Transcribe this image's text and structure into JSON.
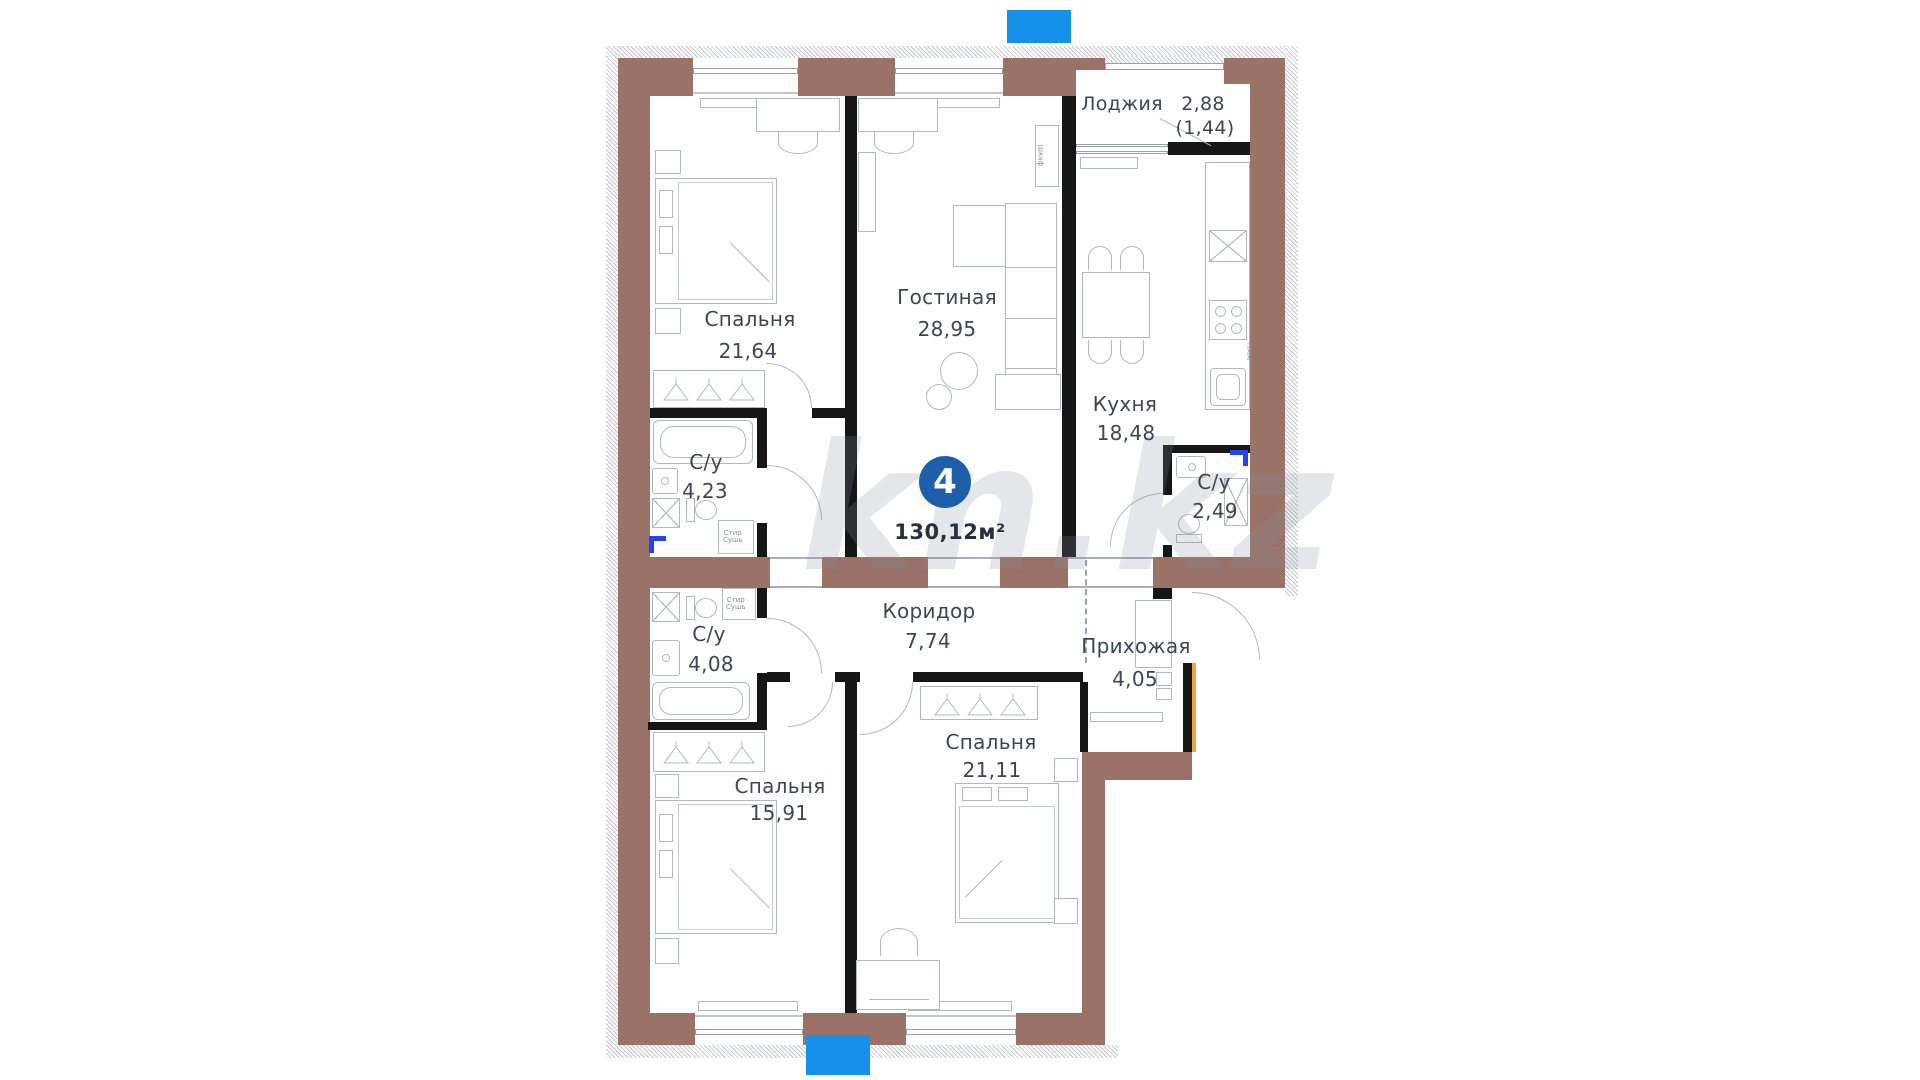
{
  "badge": {
    "count": "4",
    "total_area": "130,12м²"
  },
  "watermark": "kn.kz",
  "rooms": [
    {
      "id": "bedroom-top",
      "name": "Спальня",
      "area": "21,64"
    },
    {
      "id": "living-room",
      "name": "Гостиная",
      "area": "28,95"
    },
    {
      "id": "loggia",
      "name": "Лоджия",
      "area": "2,88",
      "area_coeff": "(1,44)"
    },
    {
      "id": "kitchen",
      "name": "Кухня",
      "area": "18,48"
    },
    {
      "id": "bathroom-1",
      "name": "С/у",
      "area": "4,23"
    },
    {
      "id": "bathroom-2",
      "name": "С/у",
      "area": "2,49"
    },
    {
      "id": "corridor",
      "name": "Коридор",
      "area": "7,74"
    },
    {
      "id": "hallway",
      "name": "Прихожая",
      "area": "4,05"
    },
    {
      "id": "bathroom-3",
      "name": "С/у",
      "area": "4,08"
    },
    {
      "id": "bedroom-left",
      "name": "Спальня",
      "area": "15,91"
    },
    {
      "id": "bedroom-right",
      "name": "Спальня",
      "area": "21,11"
    }
  ],
  "appliances": {
    "washer_dryer": "Стир\nСушь",
    "dishwasher": "ПММ",
    "cabinet": "Шкаф"
  },
  "colors": {
    "wall_exterior": "#9a7268",
    "wall_interior": "#161616",
    "accent_blue": "#1591ea",
    "badge_blue": "#1d5fa8",
    "entry_door_orange": "#f0a03c",
    "furniture_line": "#b3b8c0",
    "label_text": "#3e4553"
  }
}
